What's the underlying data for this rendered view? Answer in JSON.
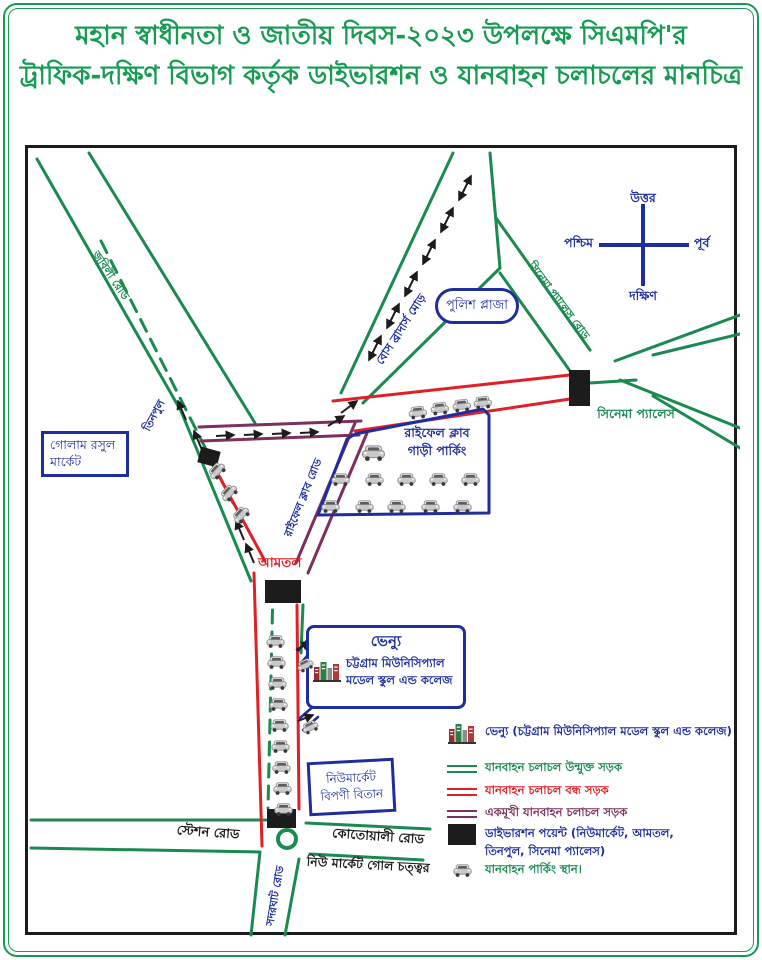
{
  "title": {
    "line1": "মহান স্বাধীনতা ও জাতীয় দিবস-২০২৩ উপলক্ষে সিএমপি'র",
    "line2": "ট্রাফিক-দক্ষিণ বিভাগ কর্তৃক ডাইভারশন ও যানবাহন চলাচলের মানচিত্র"
  },
  "compass": {
    "north": "উত্তর",
    "south": "দক্ষিণ",
    "east": "পূর্ব",
    "west": "পশ্চিম"
  },
  "map": {
    "golam_rasul_1": "গোলাম রসুল",
    "golam_rasul_2": "মার্কেট",
    "tinpul": "তিনপুল",
    "jubilee_road": "জুবিলী রোড",
    "bose_brothers": "বোস ব্রাদার্স মোড়",
    "police_plaza": "পুলিশ প্লাজা",
    "cinema_palace_road": "সিনেমা প্যালেস রোড",
    "cinema_palace": "সিনেমা প্যালেস",
    "rifle_parking_1": "রাইফেল ক্লাব",
    "rifle_parking_2": "গাড়ী পার্কিং",
    "rifle_club_road": "রাইফেল ক্লাব রোড",
    "amtol": "আমতল",
    "venue_title": "ভেন্যু",
    "venue_1": "চট্টগ্রাম মিউনিসিপ্যাল",
    "venue_2": "মডেল স্কুল এন্ড কলেজ",
    "bipani_1": "নিউমার্কেট",
    "bipani_2": "বিপণী বিতান",
    "station_road": "স্টেশন রোড",
    "kotwali_road": "কোতোয়ালী রোড",
    "gol_chattar": "নিউ মার্কেট গোল চত্ত্বর",
    "sadarghat_road": "সদরঘাট রোড"
  },
  "legend": {
    "items": [
      {
        "icon": "venue-building",
        "text": "ভেন্যু (চট্টগ্রাম মিউনিসিপ্যাল মডেল স্কুল এন্ড কলেজ)",
        "color": "blue"
      },
      {
        "icon": "open-road-line",
        "text": "যানবাহন চলাচল উন্মুক্ত সড়ক",
        "color": "green"
      },
      {
        "icon": "closed-road-line",
        "text": "যানবাহন চলাচল বন্ধ সড়ক",
        "color": "red"
      },
      {
        "icon": "oneway-road-line",
        "text": "একমূখী যানবাহন চলাচল সড়ক",
        "color": "purple"
      },
      {
        "icon": "diversion-rect",
        "text": "ডাইভারশন পয়েন্ট (নিউমার্কেট, আমতল,",
        "text2": "তিনপুল, সিনেমা প্যালেস)",
        "color": "blue"
      },
      {
        "icon": "car",
        "text": "যানবাহন পার্কিং স্থান।",
        "color": "green"
      }
    ]
  },
  "colors": {
    "title": "#169c52",
    "road_open": "#1a8a50",
    "road_closed": "#e01f26",
    "road_oneway": "#7d2f5f",
    "label_blue": "#1f2e9e",
    "diversion_black": "#1c1c1c"
  }
}
